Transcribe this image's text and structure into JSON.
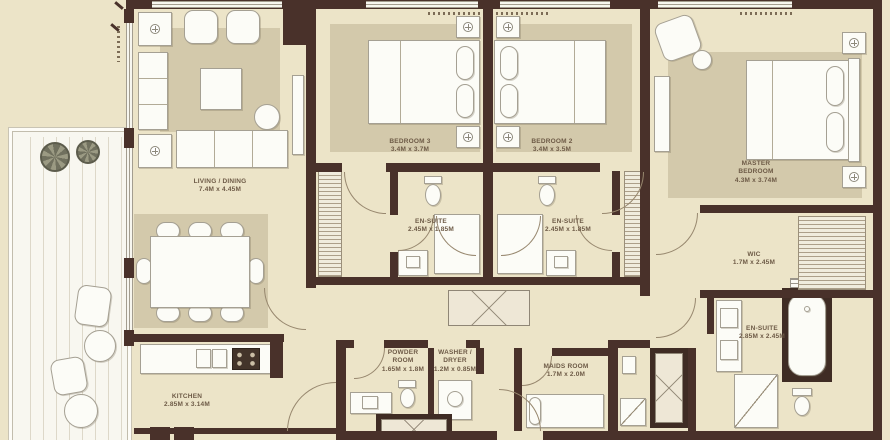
{
  "document": {
    "type": "apartment-floor-plan",
    "visible_title": ""
  },
  "colors": {
    "wall": "#49312a",
    "floor": "#ece4c8",
    "rug": "#d3c9ab",
    "fixture": "#fcfcf7",
    "fixture_outline": "#a5a093",
    "label_text": "#6d5a46",
    "balcony_deck": "#f8f7f0",
    "plant": "#70705e"
  },
  "rooms": [
    {
      "key": "living-dining",
      "name": "LIVING / DINING",
      "dimensions": "7.4M x 4.45M"
    },
    {
      "key": "bedroom-3",
      "name": "BEDROOM 3",
      "dimensions": "3.4M x 3.7M"
    },
    {
      "key": "bedroom-2",
      "name": "BEDROOM 2",
      "dimensions": "3.4M x 3.5M"
    },
    {
      "key": "master-bedroom",
      "name": "MASTER BEDROOM",
      "dimensions": "4.3M x 3.74M"
    },
    {
      "key": "ensuite-bed3",
      "name": "EN-SUITE",
      "dimensions": "2.45M x 1.85M"
    },
    {
      "key": "ensuite-bed2",
      "name": "EN-SUITE",
      "dimensions": "2.45M x 1.85M"
    },
    {
      "key": "wic",
      "name": "WIC",
      "dimensions": "1.7M x 2.45M"
    },
    {
      "key": "master-ensuite",
      "name": "EN-SUITE",
      "dimensions": "2.85M x 2.45M"
    },
    {
      "key": "powder-room",
      "name": "POWDER ROOM",
      "dimensions": "1.65M x 1.8M"
    },
    {
      "key": "washer-dryer",
      "name": "WASHER / DRYER",
      "dimensions": "1.2M x 0.85M"
    },
    {
      "key": "maids-room",
      "name": "MAIDS ROOM",
      "dimensions": "1.7M x 2.0M"
    },
    {
      "key": "kitchen",
      "name": "KITCHEN",
      "dimensions": "2.85M x 3.14M"
    }
  ]
}
